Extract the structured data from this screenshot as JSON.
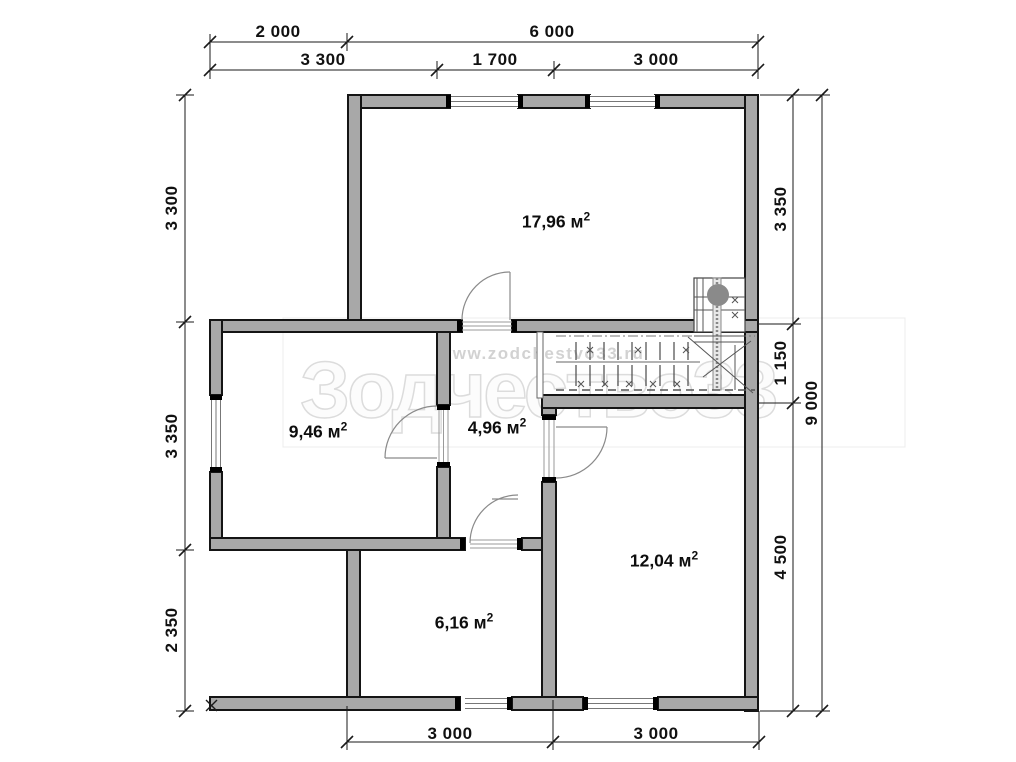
{
  "title": "floor-plan",
  "dimensions": {
    "top_primary": [
      "2 000",
      "6 000"
    ],
    "top_secondary": [
      "3 300",
      "1 700",
      "3 000"
    ],
    "left": [
      "3 300",
      "3 350",
      "2 350"
    ],
    "right_segments": [
      "3 350",
      "1 150",
      "4 500"
    ],
    "right_total": "9 000",
    "bottom": [
      "3 000",
      "3 000"
    ]
  },
  "rooms": [
    {
      "label": "17,96 м",
      "sup": "2"
    },
    {
      "label": "9,46 м",
      "sup": "2"
    },
    {
      "label": "4,96 м",
      "sup": "2"
    },
    {
      "label": "12,04 м",
      "sup": "2"
    },
    {
      "label": "6,16 м",
      "sup": "2"
    }
  ],
  "watermark": {
    "url": "www.zodchestvo33.ru",
    "brand": "Зодчество33"
  },
  "colors": {
    "wall_fill": "#a8a8a8",
    "wall_stroke": "#151515",
    "dimension": "#111111",
    "watermark": "#dcdcdc",
    "stair_dot": "#8a8a8a"
  }
}
